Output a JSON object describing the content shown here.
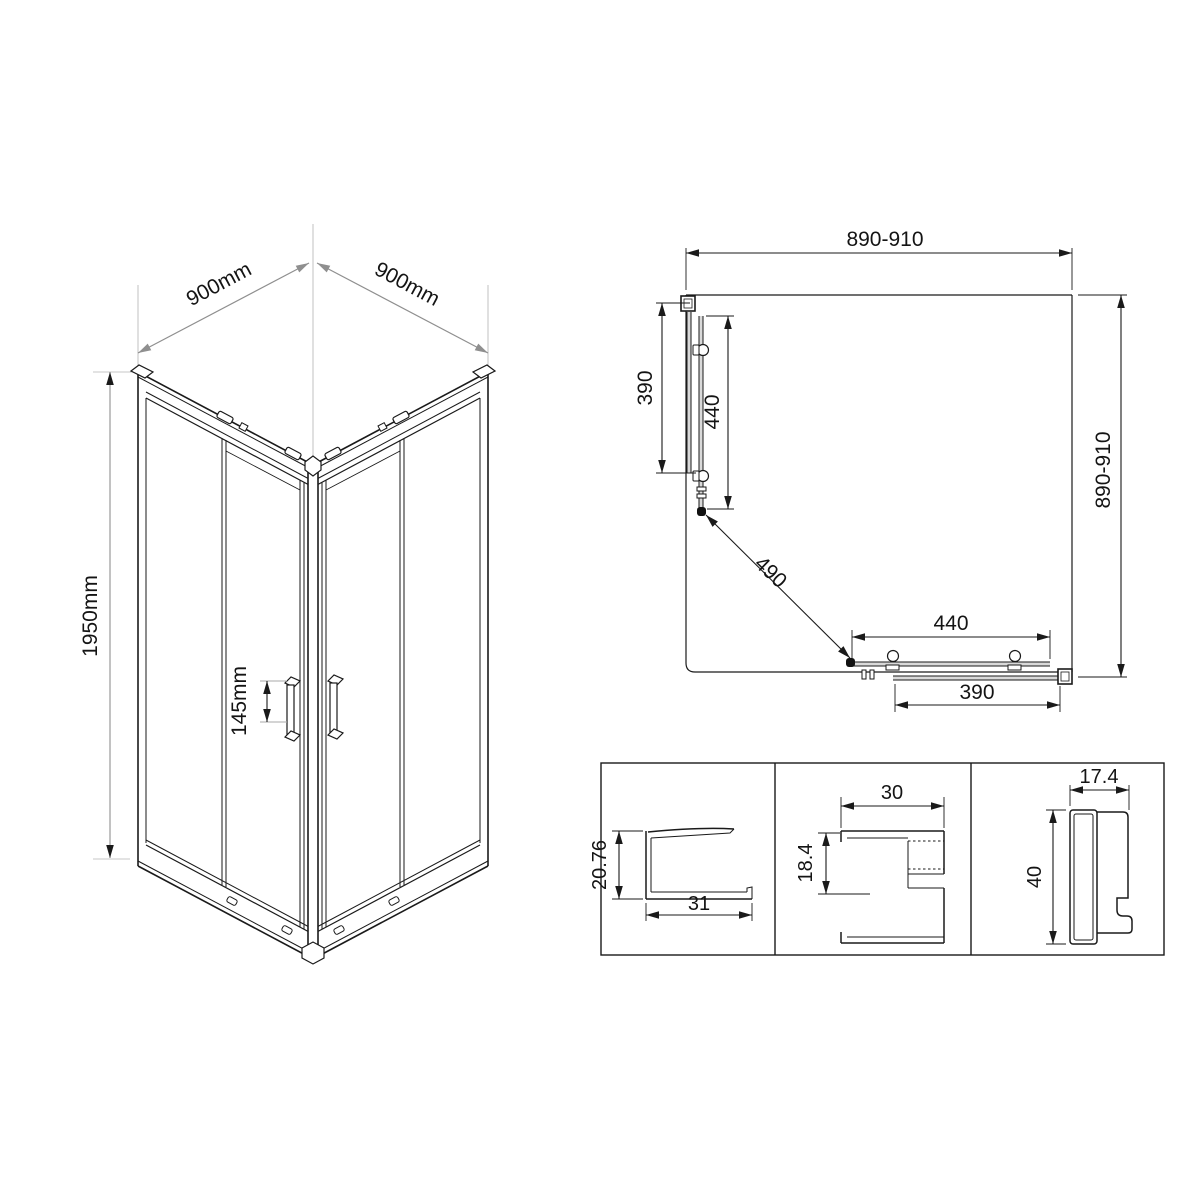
{
  "drawing": {
    "type": "shower-enclosure-technical-drawing",
    "units": "mm",
    "line_color": "#1a1a1a",
    "dim_gray": "#8f8f8f"
  },
  "iso_view": {
    "dim_width_left": "900mm",
    "dim_width_right": "900mm",
    "dim_height": "1950mm",
    "dim_handle": "145mm"
  },
  "plan_view": {
    "dim_width_top": "890-910",
    "dim_depth_right": "890-910",
    "dim_left_fixed_panel": "390",
    "dim_left_door": "440",
    "dim_diagonal_opening": "490",
    "dim_bottom_door": "440",
    "dim_bottom_fixed_panel": "390"
  },
  "profile_sections": {
    "glass_channel": {
      "height": "20.76",
      "width": "31"
    },
    "door_guide": {
      "width": "30",
      "height": "18.4"
    },
    "wall_profile": {
      "width": "17.4",
      "height": "40"
    }
  }
}
